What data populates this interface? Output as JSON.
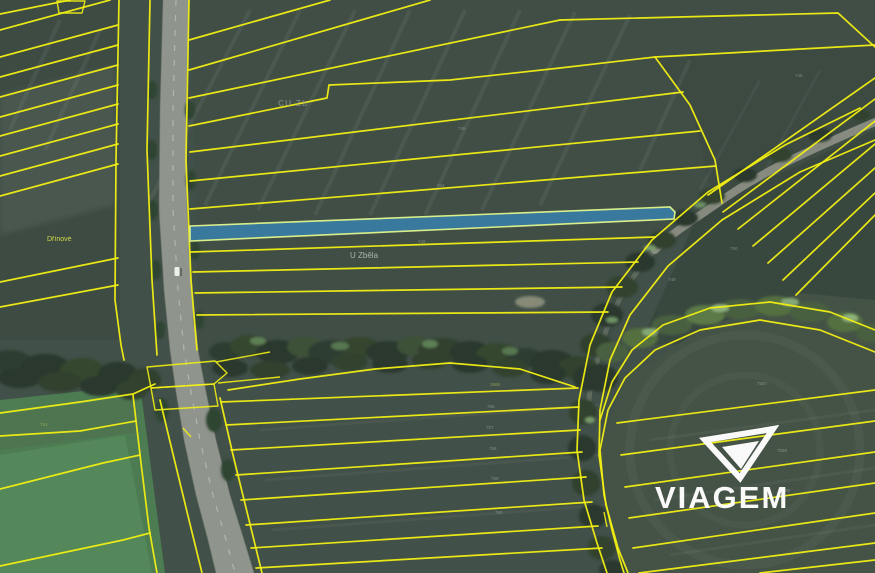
{
  "meta": {
    "description": "Aerial cadastral map with yellow parcel boundaries and one highlighted parcel strip"
  },
  "map": {
    "labels": {
      "drinove": {
        "text": "Dřínové"
      },
      "u_zbela": {
        "text": "U Zběla"
      },
      "cu_zb": {
        "text": "CU Zb"
      }
    },
    "highlight": {
      "name": "highlighted-parcel-strip"
    },
    "parcel_numbers": [
      {
        "text": "745",
        "x": 458,
        "y": 130,
        "tone": "gray"
      },
      {
        "text": "744",
        "x": 437,
        "y": 187,
        "tone": "gray"
      },
      {
        "text": "748",
        "x": 418,
        "y": 243,
        "tone": "gray"
      },
      {
        "text": "746",
        "x": 795,
        "y": 77,
        "tone": "gray"
      },
      {
        "text": "750",
        "x": 730,
        "y": 250,
        "tone": "gray"
      },
      {
        "text": "749",
        "x": 668,
        "y": 281,
        "tone": "gray"
      },
      {
        "text": "2689",
        "x": 490,
        "y": 386,
        "tone": "yellow"
      },
      {
        "text": "756",
        "x": 487,
        "y": 408,
        "tone": "gray"
      },
      {
        "text": "757",
        "x": 486,
        "y": 429,
        "tone": "gray"
      },
      {
        "text": "758",
        "x": 489,
        "y": 450,
        "tone": "gray"
      },
      {
        "text": "759",
        "x": 491,
        "y": 480,
        "tone": "gray"
      },
      {
        "text": "760",
        "x": 495,
        "y": 514,
        "tone": "gray"
      },
      {
        "text": "7587",
        "x": 757,
        "y": 385,
        "tone": "gray"
      },
      {
        "text": "7588",
        "x": 777,
        "y": 452,
        "tone": "gray"
      },
      {
        "text": "7589",
        "x": 780,
        "y": 492,
        "tone": "gray"
      },
      {
        "text": "741",
        "x": 40,
        "y": 426,
        "tone": "yellow"
      }
    ],
    "colors": {
      "boundary": "#f2ef14",
      "highlight_fill": "#3a7da6",
      "highlight_outline": "#d9ee8a",
      "field": "#415048",
      "field_bright": "#55885b",
      "road": "#8f948c",
      "trees": "#2b392d",
      "watermark": "#ffffff",
      "label_yellow": "#e8ef4a",
      "label_gray": "#cfd6c8"
    }
  },
  "watermark": {
    "text": "VIAGEM"
  }
}
